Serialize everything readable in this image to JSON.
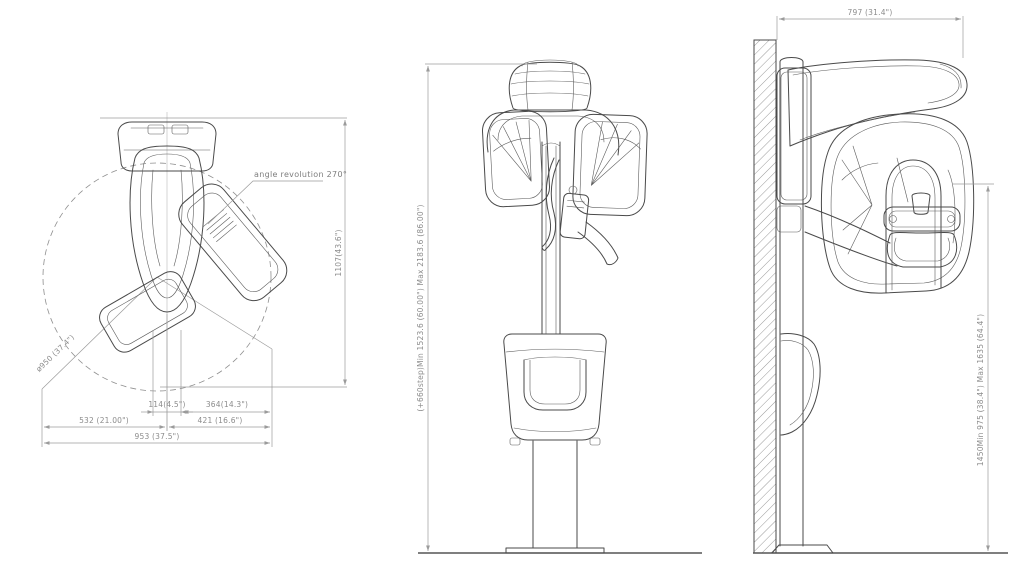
{
  "document": {
    "background": "#ffffff",
    "line_color": "#4a4a4a",
    "dim_color": "#9b9b9b"
  },
  "top_view": {
    "annotation_angle": "angle revolution 270°",
    "dim_depth": "1107(43.6\")",
    "dim_rotation_diameter": "ø950 (37.4\")",
    "dim_column_width": "114(4.5\")",
    "dim_column_to_front": "364(14.3\")",
    "dim_back_width": "532 (21.00\")",
    "dim_front_width": "421 (16.6\")",
    "dim_total_depth": "953 (37.5\")"
  },
  "front_view": {
    "dim_height_range": "(+660step)Min 1523.6 (60.00\") Max 2183.6 (86.00\")"
  },
  "side_view": {
    "dim_wall_to_front": "797 (31.4\")",
    "dim_chinrest_height_range": "1450Min 975 (38.4\") Max 1635 (64.4\")"
  }
}
